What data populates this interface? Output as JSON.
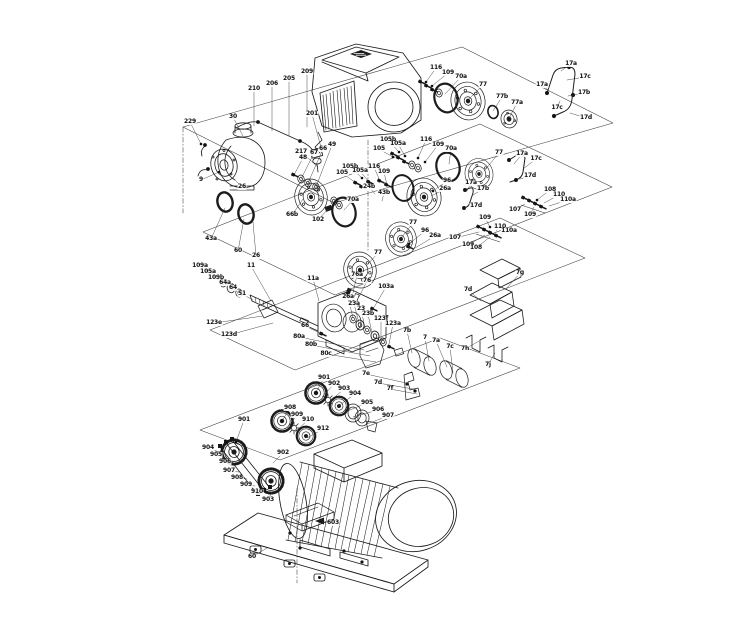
{
  "figure": {
    "type": "exploded-parts-diagram",
    "subject": "horizontal multistage pump assembly with drive motor, shaft seal kits, couplings and base plate",
    "background_color": "#ffffff",
    "line_color": "#1b1b1b",
    "label_color": "#101010"
  },
  "drawn_components": [
    "drive-motor-with-display",
    "pump-head-volute",
    "sensor-valve-assembly",
    "o-ring",
    "seal-flange-disc",
    "shaft-seal-kit",
    "vent-pipe",
    "screw-cluster",
    "pump-shaft",
    "bearing-bracket",
    "sleeve",
    "sheet-metal-guard",
    "gear-coupling",
    "coupling-star",
    "motor-clamp",
    "induction-motor",
    "base-plate"
  ],
  "callouts": [
    {
      "t": "229",
      "x": 190,
      "y": 122,
      "tx": 201,
      "ty": 144,
      "d": 1
    },
    {
      "t": "30",
      "x": 233,
      "y": 117,
      "tx": 243,
      "ty": 136
    },
    {
      "t": "210",
      "x": 254,
      "y": 89,
      "tx": 254,
      "ty": 126
    },
    {
      "t": "206",
      "x": 272,
      "y": 84,
      "tx": 272,
      "ty": 131
    },
    {
      "t": "205",
      "x": 289,
      "y": 79,
      "tx": 289,
      "ty": 136
    },
    {
      "t": "209",
      "x": 307,
      "y": 72,
      "tx": 307,
      "ty": 127
    },
    {
      "t": "201",
      "x": 312,
      "y": 114,
      "tx": 322,
      "ty": 151
    },
    {
      "t": "217",
      "x": 301,
      "y": 152,
      "tx": 318,
      "ty": 167
    },
    {
      "t": "9",
      "x": 201,
      "y": 180,
      "tx": 219,
      "ty": 172,
      "d": 1
    },
    {
      "t": "26",
      "x": 242,
      "y": 187,
      "tx": 233,
      "ty": 178
    },
    {
      "t": "43a",
      "x": 211,
      "y": 239,
      "tx": 225,
      "ty": 208
    },
    {
      "t": "60",
      "x": 238,
      "y": 251,
      "tx": 244,
      "ty": 219
    },
    {
      "t": "26",
      "x": 256,
      "y": 256,
      "tx": 253,
      "ty": 222
    },
    {
      "t": "48",
      "x": 303,
      "y": 158,
      "tx": 294,
      "ty": 175,
      "d": 1
    },
    {
      "t": "67",
      "x": 314,
      "y": 153,
      "tx": 301,
      "ty": 179
    },
    {
      "t": "66",
      "x": 323,
      "y": 149,
      "tx": 308,
      "ty": 183
    },
    {
      "t": "49",
      "x": 332,
      "y": 145,
      "tx": 316,
      "ty": 187
    },
    {
      "t": "66b",
      "x": 292,
      "y": 215,
      "tx": 303,
      "ty": 199
    },
    {
      "t": "102",
      "x": 318,
      "y": 220,
      "tx": 328,
      "ty": 209
    },
    {
      "t": "70a",
      "x": 353,
      "y": 200,
      "tx": 344,
      "ty": 210
    },
    {
      "t": "105b",
      "x": 350,
      "y": 167,
      "tx": 362,
      "ty": 178,
      "d": 1
    },
    {
      "t": "105",
      "x": 342,
      "y": 173,
      "tx": 356,
      "ty": 183,
      "d": 1
    },
    {
      "t": "105a",
      "x": 360,
      "y": 171,
      "tx": 369,
      "ty": 182,
      "d": 1
    },
    {
      "t": "116",
      "x": 374,
      "y": 167,
      "tx": 380,
      "ty": 181,
      "d": 1
    },
    {
      "t": "109",
      "x": 384,
      "y": 172,
      "tx": 387,
      "ty": 185,
      "d": 1
    },
    {
      "t": "24b",
      "x": 369,
      "y": 187,
      "tx": 375,
      "ty": 194
    },
    {
      "t": "43b",
      "x": 384,
      "y": 193,
      "tx": 382,
      "ty": 201
    },
    {
      "t": "105b",
      "x": 388,
      "y": 140,
      "tx": 399,
      "ty": 152,
      "d": 1
    },
    {
      "t": "105a",
      "x": 398,
      "y": 144,
      "tx": 405,
      "ty": 156,
      "d": 1
    },
    {
      "t": "105",
      "x": 379,
      "y": 149,
      "tx": 393,
      "ty": 157,
      "d": 1
    },
    {
      "t": "116",
      "x": 426,
      "y": 140,
      "tx": 418,
      "ty": 158,
      "d": 1
    },
    {
      "t": "109",
      "x": 438,
      "y": 145,
      "tx": 425,
      "ty": 162,
      "d": 1
    },
    {
      "t": "70a",
      "x": 451,
      "y": 149,
      "tx": 449,
      "ty": 164
    },
    {
      "t": "77",
      "x": 499,
      "y": 153,
      "tx": 484,
      "ty": 171
    },
    {
      "t": "17a",
      "x": 522,
      "y": 154,
      "tx": 514,
      "ty": 164
    },
    {
      "t": "17c",
      "x": 536,
      "y": 159,
      "tx": 523,
      "ty": 169
    },
    {
      "t": "17d",
      "x": 530,
      "y": 176,
      "tx": 520,
      "ty": 179
    },
    {
      "t": "96",
      "x": 447,
      "y": 181,
      "tx": 433,
      "ty": 191,
      "d": 1
    },
    {
      "t": "26a",
      "x": 445,
      "y": 189,
      "tx": 431,
      "ty": 196
    },
    {
      "t": "17a",
      "x": 471,
      "y": 183,
      "tx": 467,
      "ty": 191
    },
    {
      "t": "17b",
      "x": 483,
      "y": 189,
      "tx": 473,
      "ty": 195
    },
    {
      "t": "17d",
      "x": 476,
      "y": 206,
      "tx": 470,
      "ty": 204
    },
    {
      "t": "77",
      "x": 413,
      "y": 223,
      "tx": 401,
      "ty": 238
    },
    {
      "t": "96",
      "x": 425,
      "y": 231,
      "tx": 409,
      "ty": 244,
      "d": 1
    },
    {
      "t": "26a",
      "x": 435,
      "y": 236,
      "tx": 415,
      "ty": 248
    },
    {
      "t": "108",
      "x": 550,
      "y": 190,
      "tx": 537,
      "ty": 200,
      "d": 1
    },
    {
      "t": "110",
      "x": 559,
      "y": 195,
      "tx": 544,
      "ty": 203
    },
    {
      "t": "110a",
      "x": 568,
      "y": 200,
      "tx": 549,
      "ty": 206
    },
    {
      "t": "107",
      "x": 515,
      "y": 210,
      "tx": 525,
      "ty": 204
    },
    {
      "t": "109",
      "x": 530,
      "y": 215,
      "tx": 534,
      "ty": 207
    },
    {
      "t": "109",
      "x": 485,
      "y": 218,
      "tx": 490,
      "ty": 227,
      "d": 1
    },
    {
      "t": "110",
      "x": 500,
      "y": 227,
      "tx": 496,
      "ty": 231
    },
    {
      "t": "110a",
      "x": 509,
      "y": 231,
      "tx": 501,
      "ty": 234
    },
    {
      "t": "107",
      "x": 455,
      "y": 238,
      "tx": 479,
      "ty": 232
    },
    {
      "t": "109",
      "x": 468,
      "y": 245,
      "tx": 485,
      "ty": 235
    },
    {
      "t": "108",
      "x": 476,
      "y": 248,
      "tx": 490,
      "ty": 237
    },
    {
      "t": "116",
      "x": 436,
      "y": 68,
      "tx": 426,
      "ty": 82,
      "d": 1
    },
    {
      "t": "109",
      "x": 448,
      "y": 73,
      "tx": 432,
      "ty": 86,
      "d": 1
    },
    {
      "t": "70a",
      "x": 461,
      "y": 77,
      "tx": 445,
      "ty": 94
    },
    {
      "t": "77",
      "x": 483,
      "y": 85,
      "tx": 469,
      "ty": 99
    },
    {
      "t": "77b",
      "x": 502,
      "y": 97,
      "tx": 493,
      "ty": 111
    },
    {
      "t": "77a",
      "x": 517,
      "y": 103,
      "tx": 509,
      "ty": 118
    },
    {
      "t": "17a",
      "x": 571,
      "y": 64,
      "tx": 561,
      "ty": 71
    },
    {
      "t": "17c",
      "x": 585,
      "y": 77,
      "tx": 567,
      "ty": 80
    },
    {
      "t": "17a",
      "x": 542,
      "y": 85,
      "tx": 549,
      "ty": 91
    },
    {
      "t": "17b",
      "x": 584,
      "y": 93,
      "tx": 568,
      "ty": 96
    },
    {
      "t": "17c",
      "x": 557,
      "y": 108,
      "tx": 560,
      "ty": 101
    },
    {
      "t": "17d",
      "x": 586,
      "y": 118,
      "tx": 570,
      "ty": 113
    },
    {
      "t": "77",
      "x": 378,
      "y": 253,
      "tx": 368,
      "ty": 264
    },
    {
      "t": "109a",
      "x": 200,
      "y": 266,
      "tx": 208,
      "ty": 271,
      "d": 1
    },
    {
      "t": "105a",
      "x": 208,
      "y": 272,
      "tx": 215,
      "ty": 277
    },
    {
      "t": "109b",
      "x": 216,
      "y": 278,
      "tx": 223,
      "ty": 283
    },
    {
      "t": "64a",
      "x": 225,
      "y": 283,
      "tx": 231,
      "ty": 288
    },
    {
      "t": "64",
      "x": 233,
      "y": 288,
      "tx": 239,
      "ty": 293
    },
    {
      "t": "51",
      "x": 242,
      "y": 294,
      "tx": 253,
      "ty": 300
    },
    {
      "t": "11",
      "x": 251,
      "y": 266,
      "tx": 271,
      "ty": 301
    },
    {
      "t": "11a",
      "x": 313,
      "y": 279,
      "tx": 319,
      "ty": 301
    },
    {
      "t": "76a",
      "x": 357,
      "y": 275,
      "tx": 353,
      "ty": 293
    },
    {
      "t": "76",
      "x": 367,
      "y": 281,
      "tx": 359,
      "ty": 297
    },
    {
      "t": "103a",
      "x": 386,
      "y": 287,
      "tx": 373,
      "ty": 309
    },
    {
      "t": "123e",
      "x": 214,
      "y": 323,
      "tx": 263,
      "ty": 316
    },
    {
      "t": "123d",
      "x": 229,
      "y": 335,
      "tx": 273,
      "ty": 323
    },
    {
      "t": "66",
      "x": 305,
      "y": 326,
      "tx": 322,
      "ty": 334,
      "d": 1
    },
    {
      "t": "80a",
      "x": 299,
      "y": 337,
      "tx": 364,
      "ty": 350
    },
    {
      "t": "80b",
      "x": 311,
      "y": 345,
      "tx": 370,
      "ty": 356
    },
    {
      "t": "80c",
      "x": 326,
      "y": 354,
      "tx": 376,
      "ty": 362
    },
    {
      "t": "26a",
      "x": 348,
      "y": 297,
      "tx": 353,
      "ty": 318
    },
    {
      "t": "23a",
      "x": 354,
      "y": 304,
      "tx": 359,
      "ty": 323
    },
    {
      "t": "23",
      "x": 361,
      "y": 309,
      "tx": 365,
      "ty": 328
    },
    {
      "t": "23b",
      "x": 368,
      "y": 314,
      "tx": 372,
      "ty": 333
    },
    {
      "t": "123f",
      "x": 381,
      "y": 319,
      "tx": 381,
      "ty": 339
    },
    {
      "t": "123a",
      "x": 393,
      "y": 324,
      "tx": 389,
      "ty": 344
    },
    {
      "t": "7b",
      "x": 407,
      "y": 331,
      "tx": 412,
      "ty": 353
    },
    {
      "t": "7",
      "x": 425,
      "y": 338,
      "tx": 429,
      "ty": 361
    },
    {
      "t": "7c",
      "x": 450,
      "y": 347,
      "tx": 453,
      "ty": 373
    },
    {
      "t": "7a",
      "x": 436,
      "y": 341,
      "tx": 447,
      "ty": 367
    },
    {
      "t": "7e",
      "x": 366,
      "y": 374,
      "tx": 406,
      "ty": 383
    },
    {
      "t": "7d",
      "x": 378,
      "y": 383,
      "tx": 413,
      "ty": 389
    },
    {
      "t": "7f",
      "x": 390,
      "y": 389,
      "tx": 417,
      "ty": 394
    },
    {
      "t": "7g",
      "x": 520,
      "y": 273,
      "tx": 506,
      "ty": 289
    },
    {
      "t": "7d",
      "x": 468,
      "y": 290,
      "tx": 481,
      "ty": 301
    },
    {
      "t": "7h",
      "x": 465,
      "y": 349,
      "tx": 479,
      "ty": 341
    },
    {
      "t": "7j",
      "x": 488,
      "y": 365,
      "tx": 495,
      "ty": 353
    },
    {
      "t": "901",
      "x": 324,
      "y": 378,
      "tx": 316,
      "ty": 392,
      "d": 1
    },
    {
      "t": "902",
      "x": 334,
      "y": 384,
      "tx": 322,
      "ty": 397
    },
    {
      "t": "903",
      "x": 344,
      "y": 389,
      "tx": 329,
      "ty": 402
    },
    {
      "t": "904",
      "x": 355,
      "y": 394,
      "tx": 337,
      "ty": 407
    },
    {
      "t": "905",
      "x": 367,
      "y": 403,
      "tx": 345,
      "ty": 412
    },
    {
      "t": "906",
      "x": 378,
      "y": 410,
      "tx": 353,
      "ty": 417
    },
    {
      "t": "907",
      "x": 388,
      "y": 416,
      "tx": 367,
      "ty": 424
    },
    {
      "t": "908",
      "x": 290,
      "y": 408,
      "tx": 282,
      "ty": 421,
      "d": 1
    },
    {
      "t": "909",
      "x": 297,
      "y": 415,
      "tx": 288,
      "ty": 427
    },
    {
      "t": "910",
      "x": 308,
      "y": 420,
      "tx": 295,
      "ty": 432
    },
    {
      "t": "912",
      "x": 323,
      "y": 429,
      "tx": 307,
      "ty": 438
    },
    {
      "t": "901",
      "x": 244,
      "y": 420,
      "tx": 236,
      "ty": 442,
      "d": 1
    },
    {
      "t": "904",
      "x": 208,
      "y": 448,
      "tx": 222,
      "ty": 453,
      "d": 1
    },
    {
      "t": "905",
      "x": 216,
      "y": 455,
      "tx": 228,
      "ty": 459
    },
    {
      "t": "906",
      "x": 225,
      "y": 462,
      "tx": 234,
      "ty": 464
    },
    {
      "t": "907",
      "x": 229,
      "y": 471,
      "tx": 239,
      "ty": 472
    },
    {
      "t": "908",
      "x": 237,
      "y": 478,
      "tx": 247,
      "ty": 479
    },
    {
      "t": "909",
      "x": 246,
      "y": 485,
      "tx": 255,
      "ty": 486
    },
    {
      "t": "910",
      "x": 257,
      "y": 492,
      "tx": 263,
      "ty": 492
    },
    {
      "t": "902",
      "x": 283,
      "y": 453,
      "tx": 273,
      "ty": 463
    },
    {
      "t": "903",
      "x": 268,
      "y": 500,
      "tx": 272,
      "ty": 492
    },
    {
      "t": "603",
      "x": 333,
      "y": 523,
      "tx": 324,
      "ty": 521
    },
    {
      "t": "60",
      "x": 252,
      "y": 557,
      "tx": 267,
      "ty": 548
    }
  ]
}
